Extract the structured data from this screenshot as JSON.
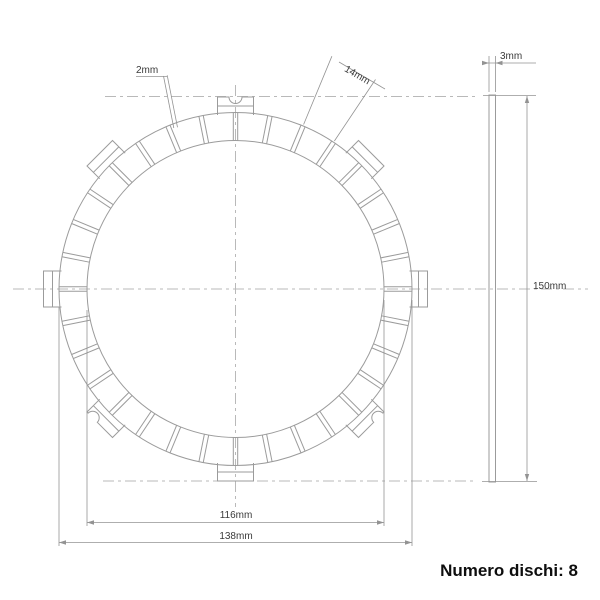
{
  "drawing": {
    "front_view": {
      "label_groove_width": "2mm",
      "label_pad_width": "14mm",
      "label_inner_diameter": "116mm",
      "label_outer_diameter": "138mm"
    },
    "side_view": {
      "label_thickness": "3mm",
      "label_overall_diameter": "150mm"
    },
    "note": "Numero dischi: 8",
    "colors": {
      "line": "#9b9b9b",
      "centerline": "#b9b9b9",
      "dimension": "#939393",
      "label_text": "#3a3a3a",
      "note_text": "#0e0e0e"
    }
  }
}
